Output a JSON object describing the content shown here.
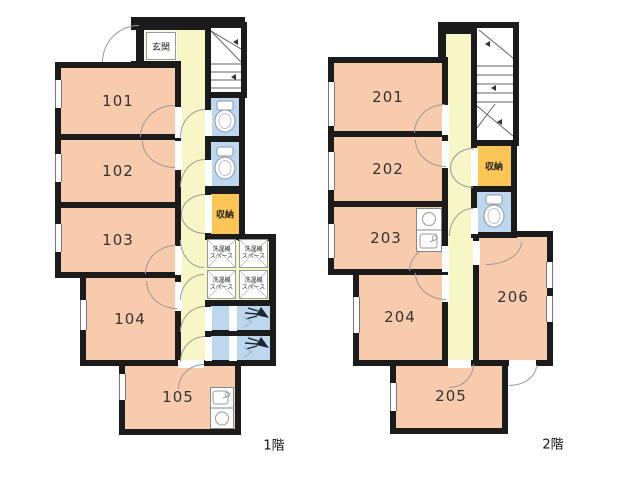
{
  "floor1": {
    "caption": "1階",
    "entrance_label": "玄関",
    "storage_label": "収納",
    "washer_line1": "洗濯機",
    "washer_line2": "スペース",
    "rooms": {
      "r101": "101",
      "r102": "102",
      "r103": "103",
      "r104": "104",
      "r105": "105"
    }
  },
  "floor2": {
    "caption": "2階",
    "storage_label": "収納",
    "rooms": {
      "r201": "201",
      "r202": "202",
      "r203": "203",
      "r204": "204",
      "r205": "205",
      "r206": "206"
    }
  },
  "colors": {
    "wall": "#1b1b1b",
    "room_fill": "#F8CBAD",
    "corridor_fill": "#F7F6C6",
    "entrance_fill": "#FBFAE4",
    "storage_fill": "#FBC655",
    "sanitary_fill": "#BDD7EE",
    "door_arc_line": "#999999"
  },
  "icons": {
    "toilet": "toilet-icon",
    "shower": "shower-icon",
    "stairs": "stairs-icon",
    "kitchenette": "kitchenette-icon"
  }
}
